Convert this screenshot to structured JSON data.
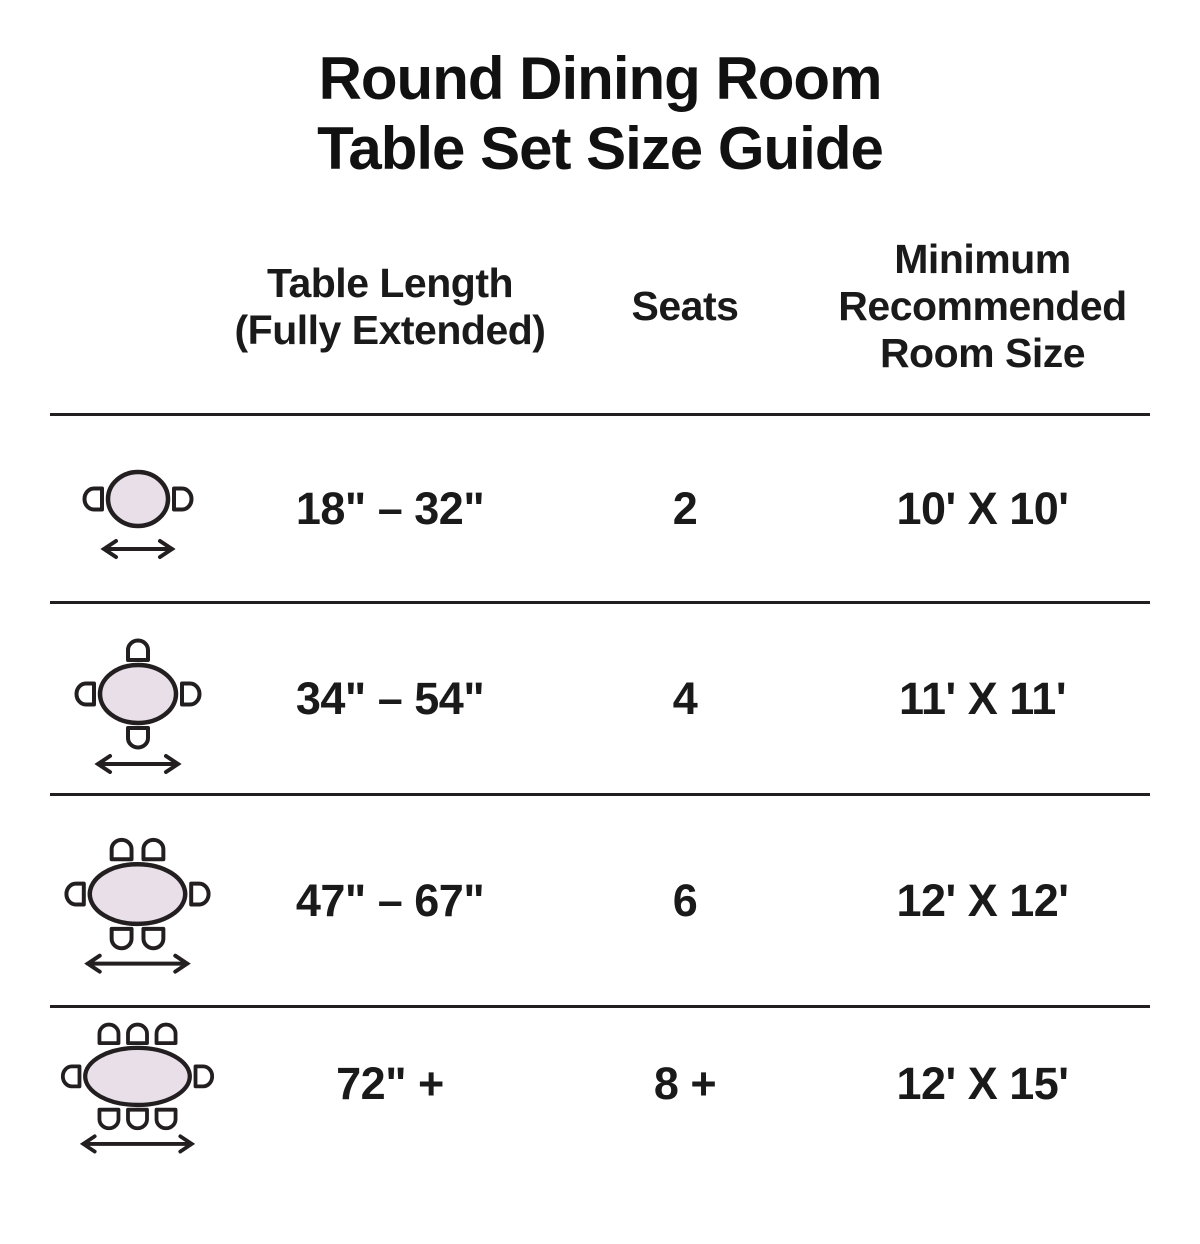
{
  "title": {
    "line1": "Round Dining Room",
    "line2": "Table Set Size Guide"
  },
  "columns": {
    "icon": "",
    "length": "Table Length\n(Fully Extended)",
    "seats": "Seats",
    "room": "Minimum\nRecommended\nRoom Size"
  },
  "rows": [
    {
      "icon": "round-table-2-seats-top-view-icon",
      "length": "18\" – 32\"",
      "seats": "2",
      "room": "10' X 10'"
    },
    {
      "icon": "round-table-4-seats-top-view-icon",
      "length": "34\" – 54\"",
      "seats": "4",
      "room": "11' X 11'"
    },
    {
      "icon": "round-table-6-seats-top-view-icon",
      "length": "47\" – 67\"",
      "seats": "6",
      "room": "12' X 12'"
    },
    {
      "icon": "round-table-8-seats-top-view-icon",
      "length": "72\" +",
      "seats": "8 +",
      "room": "12' X 15'"
    }
  ],
  "colors": {
    "table_fill": "#E8DFE9",
    "outline": "#231F20",
    "text": "#1A1A1A",
    "divider": "#231F20"
  }
}
